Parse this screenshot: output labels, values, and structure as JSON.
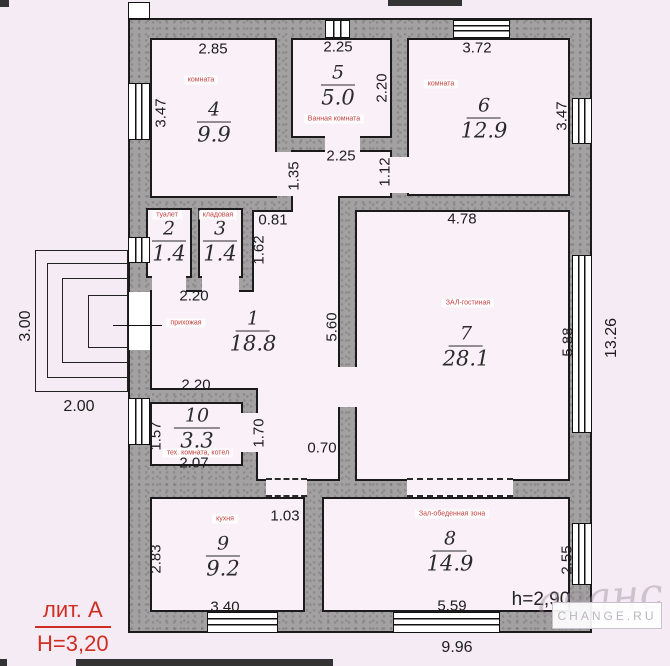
{
  "plan": {
    "litera": {
      "label": "лит. А",
      "height": "Н=3,20"
    },
    "ceiling_height": "h=2,90",
    "watermark": {
      "script": "аванс",
      "site": "CHANGE.RU"
    },
    "rooms": [
      {
        "num": "1",
        "area": "18.8",
        "name": "прихожая"
      },
      {
        "num": "2",
        "area": "1.4",
        "name": "туалет"
      },
      {
        "num": "3",
        "area": "1.4",
        "name": "кладовая"
      },
      {
        "num": "4",
        "area": "9.9",
        "name": "комната"
      },
      {
        "num": "5",
        "area": "5.0",
        "name": "Ванная комната"
      },
      {
        "num": "6",
        "area": "12.9",
        "name": "комната"
      },
      {
        "num": "7",
        "area": "28.1",
        "name": "ЗАЛ-гостиная"
      },
      {
        "num": "8",
        "area": "14.9",
        "name": "Зал-обеденная зона"
      },
      {
        "num": "9",
        "area": "9.2",
        "name": "кухня"
      },
      {
        "num": "10",
        "area": "3.3",
        "name": "тех. комната, котел"
      }
    ],
    "dims": {
      "top_r4": "2.85",
      "top_r5": "2.25",
      "top_r6": "3.72",
      "left_r4": "3.47",
      "right_r5": "2.20",
      "right_r6": "3.47",
      "below_r5": "2.25",
      "v112": "1.12",
      "v135": "1.35",
      "h081": "0.81",
      "v162": "1.62",
      "h220_r23": "2.20",
      "v560": "5.60",
      "top_r7": "4.78",
      "right_r7": "5.88",
      "right_total": "13.26",
      "porch_h": "3.00",
      "porch_w": "2.00",
      "h220_r10": "2.20",
      "left_r10": "1.57",
      "right_r10": "1.70",
      "h207": "2.07",
      "h070": "0.70",
      "h103": "1.03",
      "left_r9": "2.83",
      "bottom_r9": "3.40",
      "bottom_r8": "5.59",
      "right_r8": "2.55",
      "bottom_total": "9.96"
    }
  }
}
